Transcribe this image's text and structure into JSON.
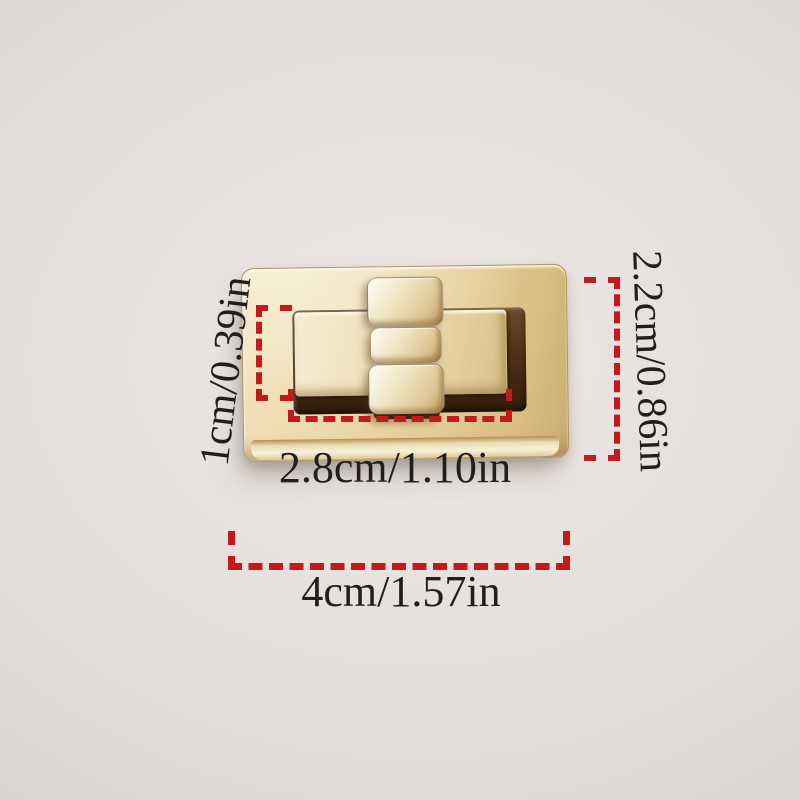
{
  "scene": {
    "background_color": "#e4dfdc"
  },
  "product": {
    "name": "gold rectangular twist-lock clasp",
    "colors": {
      "gold_highlight": "#f8f1dc",
      "gold_base": "#e9d6aa",
      "gold_shadow": "#c7a873",
      "groove_dark": "#3a2410"
    }
  },
  "dimensions": {
    "accent_color": "#c41a1c",
    "text_color": "#201e1e",
    "labels": {
      "inner_height": "1cm/0.39in",
      "outer_height": "2.2cm/0.86in",
      "inner_width": "2.8cm/1.10in",
      "outer_width": "4cm/1.57in"
    }
  }
}
